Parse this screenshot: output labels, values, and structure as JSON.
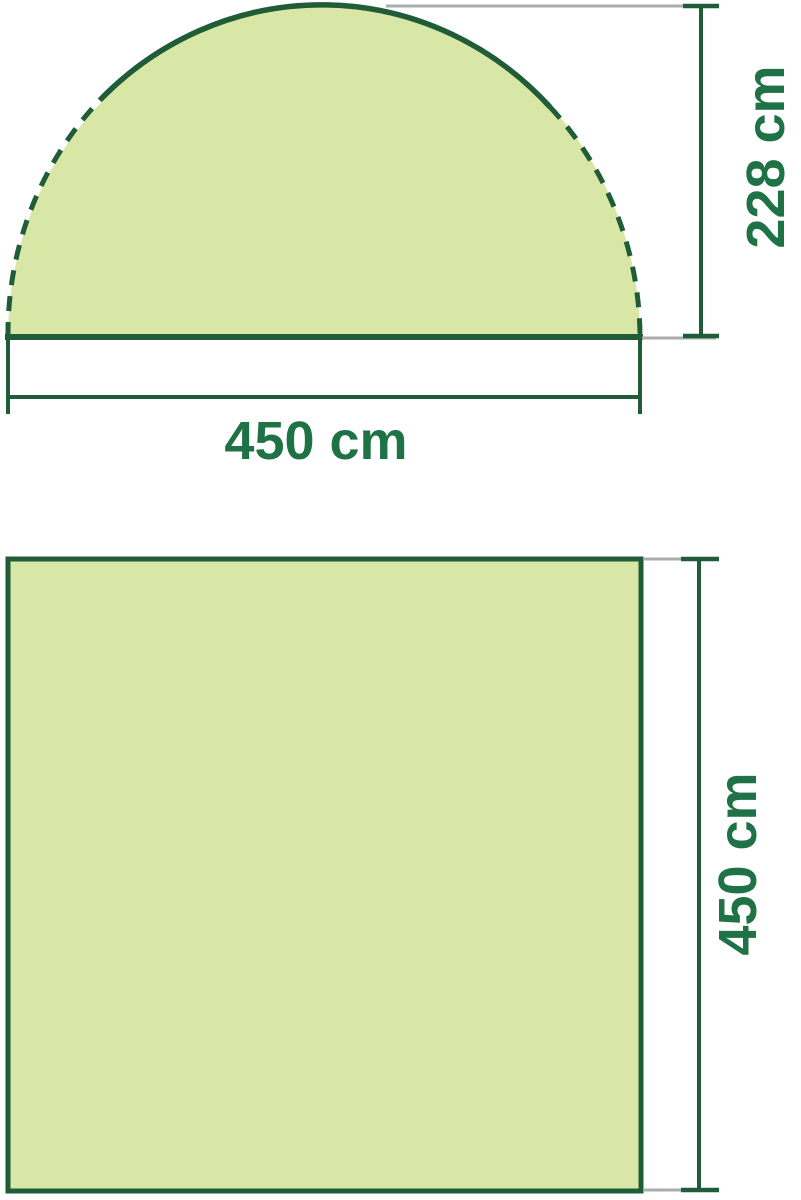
{
  "figure": {
    "side_view": {
      "base_width_label": "450 cm",
      "peak_height_label": "228 cm"
    },
    "floor_plan": {
      "depth_label": "450 cm"
    }
  },
  "colors": {
    "shape_fill": "#d8e7a6",
    "outline_green": "#1f5c37",
    "label_green": "#1e7246",
    "extension_gray": "#a9aeab"
  }
}
